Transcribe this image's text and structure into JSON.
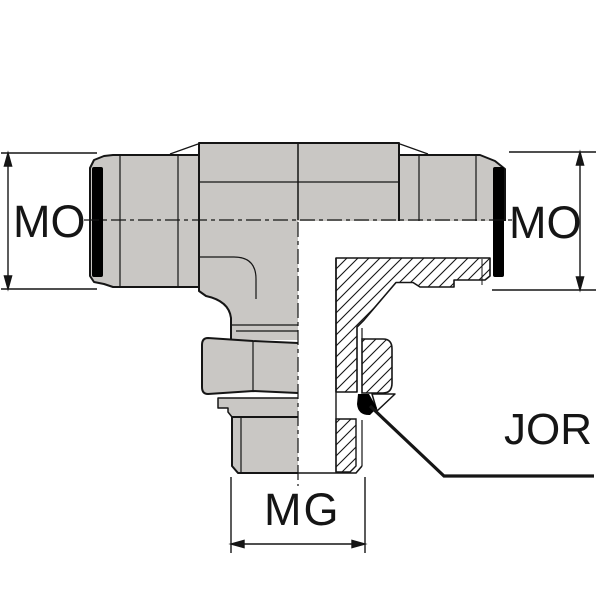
{
  "drawing": {
    "subject": "tee-fitting-half-section-technical-drawing",
    "labels": {
      "dim_left": "MO",
      "dim_right": "MO",
      "dim_bottom": "MG",
      "seal_callout": "JOR"
    },
    "colors": {
      "body_fill": "#c9c7c4",
      "outline": "#151515",
      "seal_black": "#000000",
      "background": "#ffffff"
    }
  }
}
